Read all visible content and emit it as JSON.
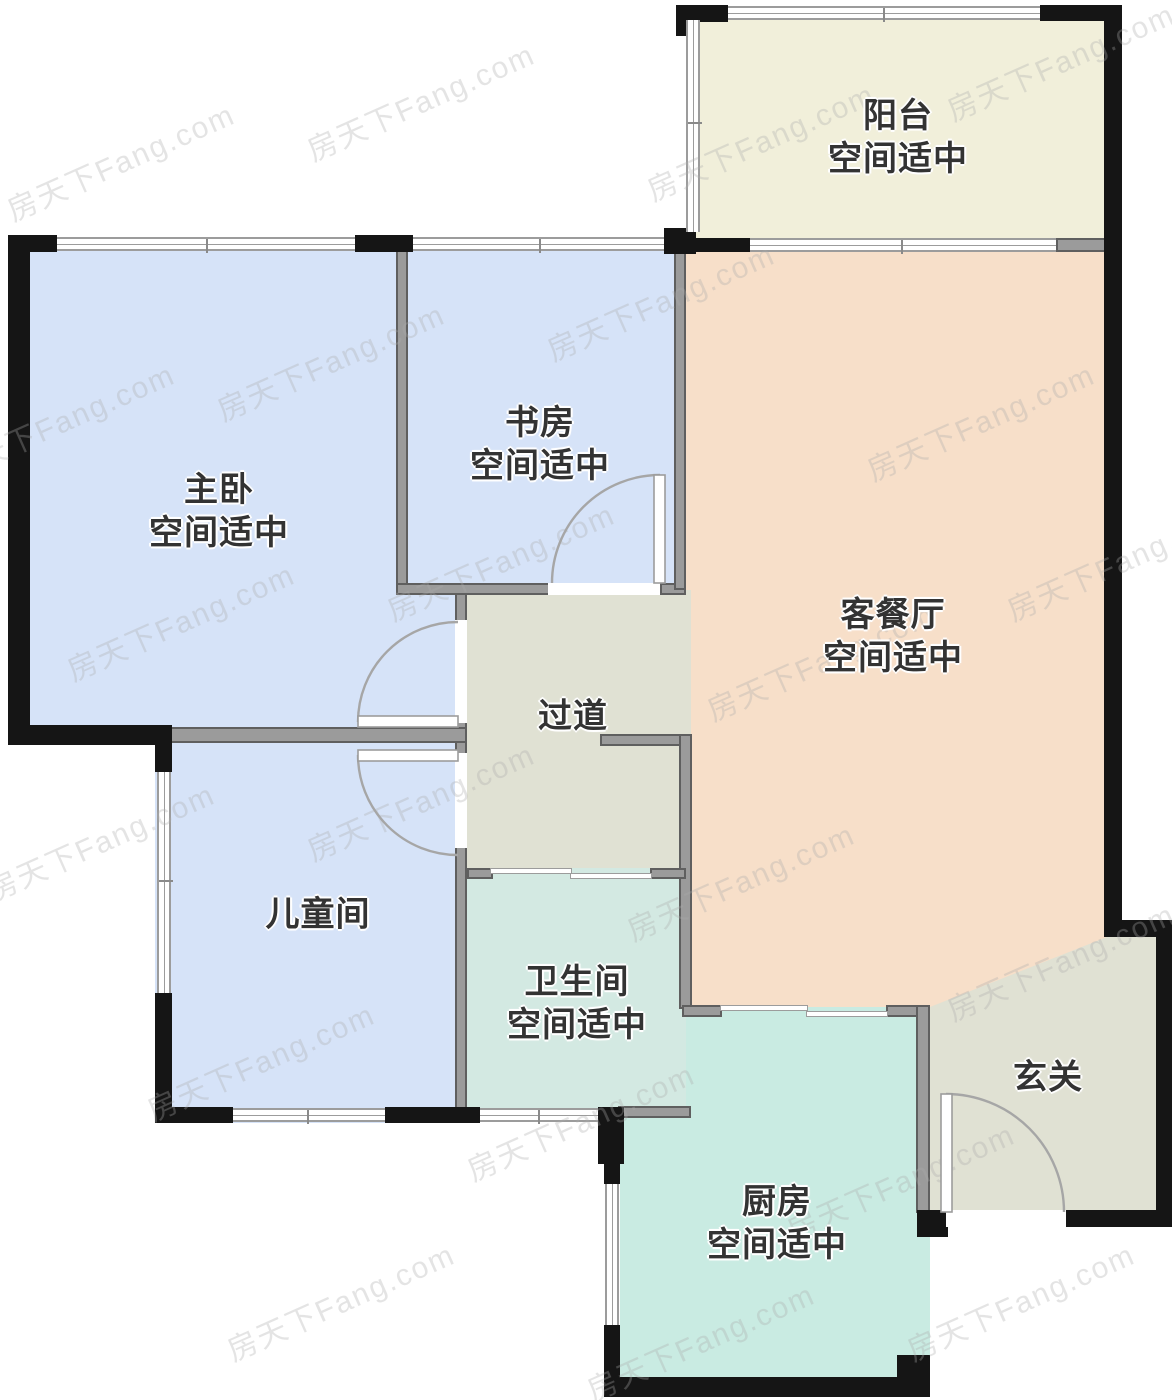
{
  "watermark": {
    "text": "房天下Fang.com"
  },
  "rooms": {
    "balcony": {
      "name": "阳台",
      "status": "空间适中"
    },
    "study": {
      "name": "书房",
      "status": "空间适中"
    },
    "master_bedroom": {
      "name": "主卧",
      "status": "空间适中"
    },
    "living_dining": {
      "name": "客餐厅",
      "status": "空间适中"
    },
    "hallway": {
      "name": "过道"
    },
    "children_room": {
      "name": "儿童间"
    },
    "bathroom": {
      "name": "卫生间",
      "status": "空间适中"
    },
    "entry": {
      "name": "玄关"
    },
    "kitchen": {
      "name": "厨房",
      "status": "空间适中"
    }
  },
  "colors": {
    "bedroom_fill": "#d6e3f8",
    "balcony_fill": "#f1efda",
    "living_fill": "#f7dfc9",
    "hallway_fill": "#e0e1d3",
    "bathroom_fill": "#d3e9e2",
    "kitchen_fill": "#c9ebe2",
    "exterior_wall": "#151515",
    "interior_wall": "#9b9b9b",
    "door_arc": "#a6a6a6"
  }
}
